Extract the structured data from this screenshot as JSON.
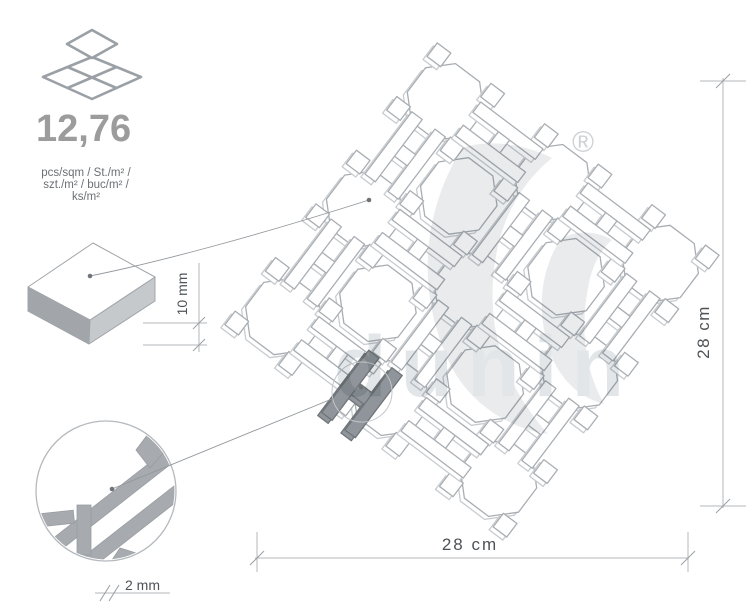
{
  "labels": {
    "quantity": "12,76",
    "units1": "pcs/sqm / St./m² /",
    "units2": "szt./m² / buc/m² /",
    "units3": "ks/m²",
    "thickness": "10 mm",
    "panel_width": "28 cm",
    "panel_height": "28 cm",
    "joint": "2 mm",
    "brand": "dunin",
    "registered": "®"
  },
  "colors": {
    "stroke": "#a9aeb3",
    "under_stroke": "#c8ccd0",
    "fill": "#ffffff",
    "icon_stroke": "#9aa0a5",
    "quantity_text": "#9c9c9c",
    "units_text": "#6b7075",
    "dim_line": "#b3b7bb",
    "dim_text": "#4e5357",
    "leader": "#94989c",
    "dot": "#6f7478",
    "tile_top": "#ffffff",
    "tile_left": "#a2a6aa",
    "tile_right": "#c6c9cc",
    "joint_gray": "#a7abaf",
    "joint_edge": "#989da1",
    "highlight_fill": "#8f959a",
    "highlight_stroke": "#6e7478",
    "watermark_swirl": "#e8eaec",
    "watermark_text": "#e2e5e7",
    "registered_mark": "#ccd0d3"
  },
  "drawing": {
    "center": [
      472,
      290
    ],
    "pitch": 95,
    "lattice_angle": -8,
    "panel_angle": 40,
    "panel_half": 170,
    "accessory_half": 185,
    "octagon_radius": 39.5,
    "bar": {
      "length": 78,
      "width": 13,
      "gap": 16
    },
    "diamond_size": 17,
    "extrude": [
      -4,
      3
    ],
    "highlight": {
      "x": 362,
      "y": 394,
      "angle": -53,
      "circle_r": 30
    }
  }
}
